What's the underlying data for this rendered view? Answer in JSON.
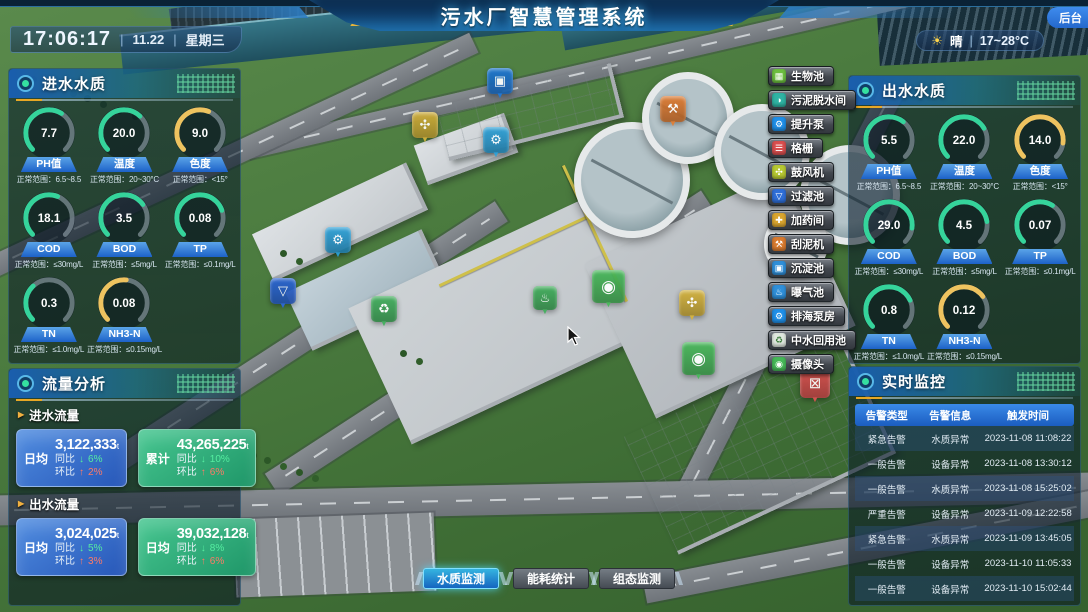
{
  "header": {
    "title": "污水厂智慧管理系统",
    "admin_label": "后台"
  },
  "clock": {
    "time": "17:06:17",
    "date": "11.22",
    "weekday": "星期三",
    "divider": "|"
  },
  "weather": {
    "icon_glyph": "☀",
    "icon": "sun-icon",
    "condition": "晴",
    "temp_range": "17~28°C"
  },
  "colors": {
    "gauge_green": "#35d49b",
    "gauge_yellow": "#eec35f",
    "trend_down_green": "#55eda0",
    "trend_up_red": "#ff7a66",
    "accent_blue": "#2f7fe0",
    "accent_yellow": "#e8b53a"
  },
  "inlet_panel": {
    "title": "进水水质",
    "gauges": [
      {
        "key": "ph",
        "label": "PH值",
        "value": "7.7",
        "range": "正常范围：6.5~8.5",
        "color": "green",
        "pct": 62
      },
      {
        "key": "temperature",
        "label": "温度",
        "value": "20.0",
        "range": "正常范围：20~30°C",
        "color": "green",
        "pct": 66
      },
      {
        "key": "chroma",
        "label": "色度",
        "value": "9.0",
        "range": "正常范围：<15°",
        "color": "yellow",
        "pct": 58
      },
      {
        "key": "cod",
        "label": "COD",
        "value": "18.1",
        "range": "正常范围：≤30mg/L",
        "color": "green",
        "pct": 58
      },
      {
        "key": "bod",
        "label": "BOD",
        "value": "3.5",
        "range": "正常范围：≤5mg/L",
        "color": "green",
        "pct": 70
      },
      {
        "key": "tp",
        "label": "TP",
        "value": "0.08",
        "range": "正常范围：≤0.1mg/L",
        "color": "green",
        "pct": 76
      },
      {
        "key": "tn",
        "label": "TN",
        "value": "0.3",
        "range": "正常范围：≤1.0mg/L",
        "color": "green",
        "pct": 34
      },
      {
        "key": "nh3n",
        "label": "NH3-N",
        "value": "0.08",
        "range": "正常范围：≤0.15mg/L",
        "color": "yellow",
        "pct": 52
      }
    ]
  },
  "outlet_panel": {
    "title": "出水水质",
    "gauges": [
      {
        "key": "ph",
        "label": "PH值",
        "value": "5.5",
        "range": "正常范围：6.5~8.5",
        "color": "green",
        "pct": 64
      },
      {
        "key": "temperature",
        "label": "温度",
        "value": "22.0",
        "range": "正常范围：20~30°C",
        "color": "green",
        "pct": 72
      },
      {
        "key": "chroma",
        "label": "色度",
        "value": "14.0",
        "range": "正常范围：<15°",
        "color": "yellow",
        "pct": 86
      },
      {
        "key": "cod",
        "label": "COD",
        "value": "29.0",
        "range": "正常范围：≤30mg/L",
        "color": "green",
        "pct": 86
      },
      {
        "key": "bod",
        "label": "BOD",
        "value": "4.5",
        "range": "正常范围：≤5mg/L",
        "color": "green",
        "pct": 80
      },
      {
        "key": "tp",
        "label": "TP",
        "value": "0.07",
        "range": "正常范围：≤0.1mg/L",
        "color": "green",
        "pct": 62
      },
      {
        "key": "tn",
        "label": "TN",
        "value": "0.8",
        "range": "正常范围：≤1.0mg/L",
        "color": "green",
        "pct": 74
      },
      {
        "key": "nh3n",
        "label": "NH3-N",
        "value": "0.12",
        "range": "正常范围：≤0.15mg/L",
        "color": "yellow",
        "pct": 70
      }
    ]
  },
  "flow_panel": {
    "title": "流量分析",
    "section_arrow": "▶",
    "yoy_label": "同比",
    "mom_label": "环比",
    "arrow_down": "↓",
    "arrow_up": "↑",
    "sections": [
      {
        "key": "inflow",
        "label": "进水流量",
        "cards": [
          {
            "stat_label": "日均",
            "value": "3,122,333",
            "unit": "t",
            "yoy_pct": "6%",
            "mom_pct": "2%",
            "style": "blue"
          },
          {
            "stat_label": "累计",
            "value": "43,265,225",
            "unit": "t",
            "yoy_pct": "10%",
            "mom_pct": "6%",
            "style": "green"
          }
        ]
      },
      {
        "key": "outflow",
        "label": "出水流量",
        "cards": [
          {
            "stat_label": "日均",
            "value": "3,024,025",
            "unit": "t",
            "yoy_pct": "5%",
            "mom_pct": "3%",
            "style": "blue"
          },
          {
            "stat_label": "日均",
            "value": "39,032,128",
            "unit": "t",
            "yoy_pct": "8%",
            "mom_pct": "6%",
            "style": "green"
          }
        ]
      }
    ]
  },
  "monitor_panel": {
    "title": "实时监控",
    "table": {
      "headers": [
        "告警类型",
        "告警信息",
        "触发时间"
      ],
      "rows": [
        [
          "紧急告警",
          "水质异常",
          "2023-11-08 11:08:22"
        ],
        [
          "一般告警",
          "设备异常",
          "2023-11-08 13:30:12"
        ],
        [
          "一般告警",
          "水质异常",
          "2023-11-08 15:25:02"
        ],
        [
          "严重告警",
          "设备异常",
          "2023-11-09 12:22:58"
        ],
        [
          "紧急告警",
          "水质异常",
          "2023-11-09 13:45:05"
        ],
        [
          "一般告警",
          "设备异常",
          "2023-11-10 11:05:33"
        ],
        [
          "一般告警",
          "设备异常",
          "2023-11-10 15:02:44"
        ]
      ]
    }
  },
  "poi_buttons": [
    {
      "key": "bio-pool",
      "label": "生物池",
      "glyph": "▦",
      "color": "#6cbf3f"
    },
    {
      "key": "sludge-dewatering",
      "label": "污泥脱水间",
      "glyph": "◑",
      "color": "#2fb3a3"
    },
    {
      "key": "lift-pump",
      "label": "提升泵",
      "glyph": "⚙",
      "color": "#1f8fe8"
    },
    {
      "key": "bar-screen",
      "label": "格栅",
      "glyph": "☰",
      "color": "#d94f4f"
    },
    {
      "key": "blower",
      "label": "鼓风机",
      "glyph": "✣",
      "color": "#b7c832"
    },
    {
      "key": "filter-pool",
      "label": "过滤池",
      "glyph": "▽",
      "color": "#2f6fd9"
    },
    {
      "key": "dosing-room",
      "label": "加药间",
      "glyph": "✚",
      "color": "#d9a52f"
    },
    {
      "key": "mud-scraper",
      "label": "刮泥机",
      "glyph": "⚒",
      "color": "#d97b2f"
    },
    {
      "key": "sedimentation-pool",
      "label": "沉淀池",
      "glyph": "▣",
      "color": "#2f8fd9"
    },
    {
      "key": "aeration-pool",
      "label": "曝气池",
      "glyph": "♨",
      "color": "#2f8fd9"
    },
    {
      "key": "sea-discharge-pump-house",
      "label": "排海泵房",
      "glyph": "⚙",
      "color": "#1f8fe8"
    },
    {
      "key": "reclaimed-water-pool",
      "label": "中水回用池",
      "glyph": "♻",
      "color": "#dfe8df",
      "glyph_color": "#3a7a3a"
    },
    {
      "key": "camera",
      "label": "摄像头",
      "glyph": "◉",
      "color": "#46b858"
    }
  ],
  "map_markers": [
    {
      "key": "sedimentation",
      "glyph": "▣",
      "color": "#1e78d8",
      "x": 487,
      "y": 68,
      "size": 26
    },
    {
      "key": "blower",
      "glyph": "✣",
      "color": "#d4b23a",
      "x": 412,
      "y": 112,
      "size": 26
    },
    {
      "key": "lift-pump",
      "glyph": "⚙",
      "color": "#2aa0d8",
      "x": 483,
      "y": 127,
      "size": 26
    },
    {
      "key": "mud-scraper",
      "glyph": "⚒",
      "color": "#e07b30",
      "x": 660,
      "y": 96,
      "size": 26
    },
    {
      "key": "lift-pump-2",
      "glyph": "⚙",
      "color": "#2aa0d8",
      "x": 325,
      "y": 227,
      "size": 26
    },
    {
      "key": "filter",
      "glyph": "▽",
      "color": "#2b66d9",
      "x": 270,
      "y": 278,
      "size": 26
    },
    {
      "key": "reuse-pool",
      "glyph": "♻",
      "color": "#3fae5a",
      "x": 371,
      "y": 296,
      "size": 26
    },
    {
      "key": "aeration",
      "glyph": "♨",
      "color": "#3fae5a",
      "x": 533,
      "y": 286,
      "size": 24
    },
    {
      "key": "camera-1",
      "glyph": "◉",
      "color": "#46b858",
      "x": 592,
      "y": 270,
      "size": 33
    },
    {
      "key": "blower-2",
      "glyph": "✣",
      "color": "#d4b23a",
      "x": 679,
      "y": 290,
      "size": 26
    },
    {
      "key": "camera-2",
      "glyph": "◉",
      "color": "#46b858",
      "x": 682,
      "y": 342,
      "size": 33
    },
    {
      "key": "lock",
      "glyph": "⊠",
      "color": "#e05252",
      "x": 800,
      "y": 368,
      "size": 30
    }
  ],
  "bottom_tabs": [
    {
      "key": "water-quality-monitor",
      "label": "水质监测",
      "active": true
    },
    {
      "key": "energy-statistics",
      "label": "能耗统计",
      "active": false
    },
    {
      "key": "scada-monitor",
      "label": "组态监测",
      "active": false
    }
  ]
}
